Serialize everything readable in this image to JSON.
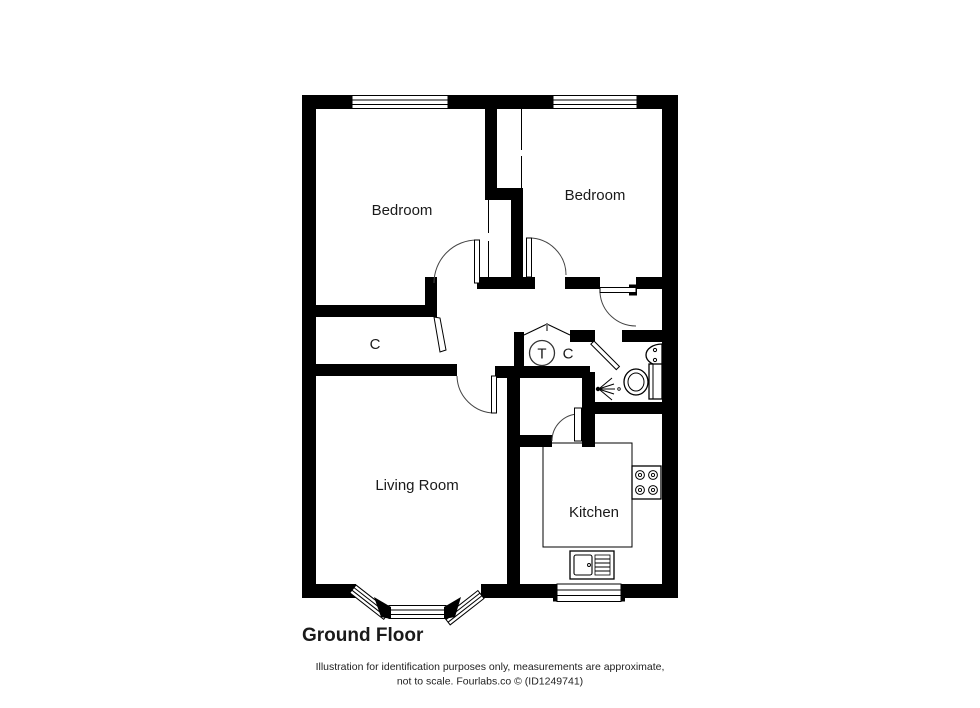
{
  "title": "Ground Floor",
  "rooms": {
    "bedroom1": "Bedroom",
    "bedroom2": "Bedroom",
    "closet1": "C",
    "tank": "T",
    "closet2": "C",
    "living": "Living Room",
    "kitchen": "Kitchen"
  },
  "footer": {
    "line1": "Illustration for identification purposes only, measurements are approximate,",
    "line2": "not to scale. Fourlabs.co © (ID1249741)"
  },
  "colors": {
    "wall": "#000000",
    "background": "#ffffff",
    "door_arc": "#444444"
  },
  "icons": [
    "bathroom-sink-icon",
    "toilet-icon",
    "shower-icon",
    "stove-icon",
    "kitchen-sink-icon",
    "bay-window",
    "window-icon",
    "bifold-door-icon"
  ]
}
